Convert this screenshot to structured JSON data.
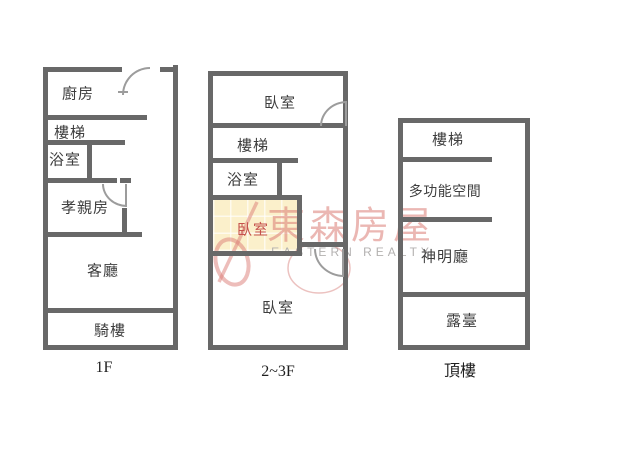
{
  "watermark": {
    "brand_cjk": "東森房屋",
    "brand_en": "EASTERN REALTY"
  },
  "plans": [
    {
      "floor_label": "1F",
      "rooms": [
        {
          "name": "kitchen",
          "label": "廚房"
        },
        {
          "name": "stairs",
          "label": "樓梯"
        },
        {
          "name": "bathroom",
          "label": "浴室"
        },
        {
          "name": "parents-room",
          "label": "孝親房"
        },
        {
          "name": "living-room",
          "label": "客廳"
        },
        {
          "name": "arcade",
          "label": "騎樓"
        }
      ]
    },
    {
      "floor_label": "2~3F",
      "rooms": [
        {
          "name": "bedroom-top",
          "label": "臥室"
        },
        {
          "name": "stairs",
          "label": "樓梯"
        },
        {
          "name": "bathroom",
          "label": "浴室"
        },
        {
          "name": "bedroom-middle",
          "label": "臥室",
          "highlighted": true
        },
        {
          "name": "bedroom-bottom",
          "label": "臥室"
        }
      ]
    },
    {
      "floor_label": "頂樓",
      "rooms": [
        {
          "name": "stairs",
          "label": "樓梯"
        },
        {
          "name": "multifunction",
          "label": "多功能空間"
        },
        {
          "name": "shrine-hall",
          "label": "神明廳"
        },
        {
          "name": "terrace",
          "label": "露臺"
        }
      ]
    }
  ],
  "colors": {
    "bg": "#ffffff",
    "wall": "#686868",
    "door": "#9c9c9c",
    "room-label": "#3e3e3e",
    "floor-label": "#1f1f1f",
    "highlight-bg": "#fbf0cb",
    "highlight-text": "#c5524c",
    "watermark-red": "#db7b75",
    "watermark-gray": "#b3b1b0"
  }
}
